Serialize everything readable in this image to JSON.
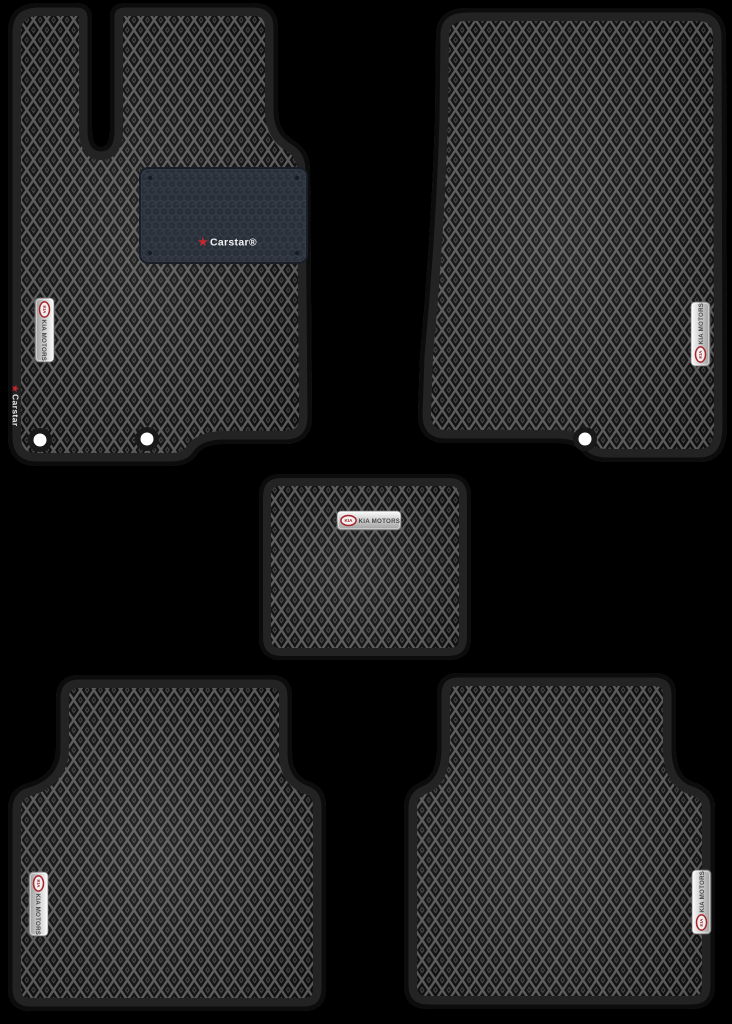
{
  "scene": {
    "description": "Set of five EVA car floor mats with diamond pattern, black borders, for KIA",
    "background_color": "#000000"
  },
  "branding": {
    "heel_pad_logo": "Carstar®",
    "edge_label": "Carstar",
    "badge_text": "KIA MOTORS",
    "badge_logo": "KIA"
  },
  "colors": {
    "mat_border": "#232323",
    "mat_outer_edge": "#0c0c0c",
    "pattern_line": "#585858",
    "pattern_cell": "#0c0c0c",
    "heel_pad_base": "#2a303a",
    "heel_pad_line": "#3a424e",
    "badge_silver": "#d8d8d8",
    "badge_text_color": "#474747",
    "kia_red": "#a8262b",
    "star_red": "#c4272e",
    "fastener_white": "#ffffff"
  },
  "mats": {
    "front_left": {
      "name": "driver front mat"
    },
    "front_right": {
      "name": "passenger front mat"
    },
    "center": {
      "name": "center tunnel mat"
    },
    "rear_left": {
      "name": "rear left mat"
    },
    "rear_right": {
      "name": "rear right mat"
    }
  }
}
